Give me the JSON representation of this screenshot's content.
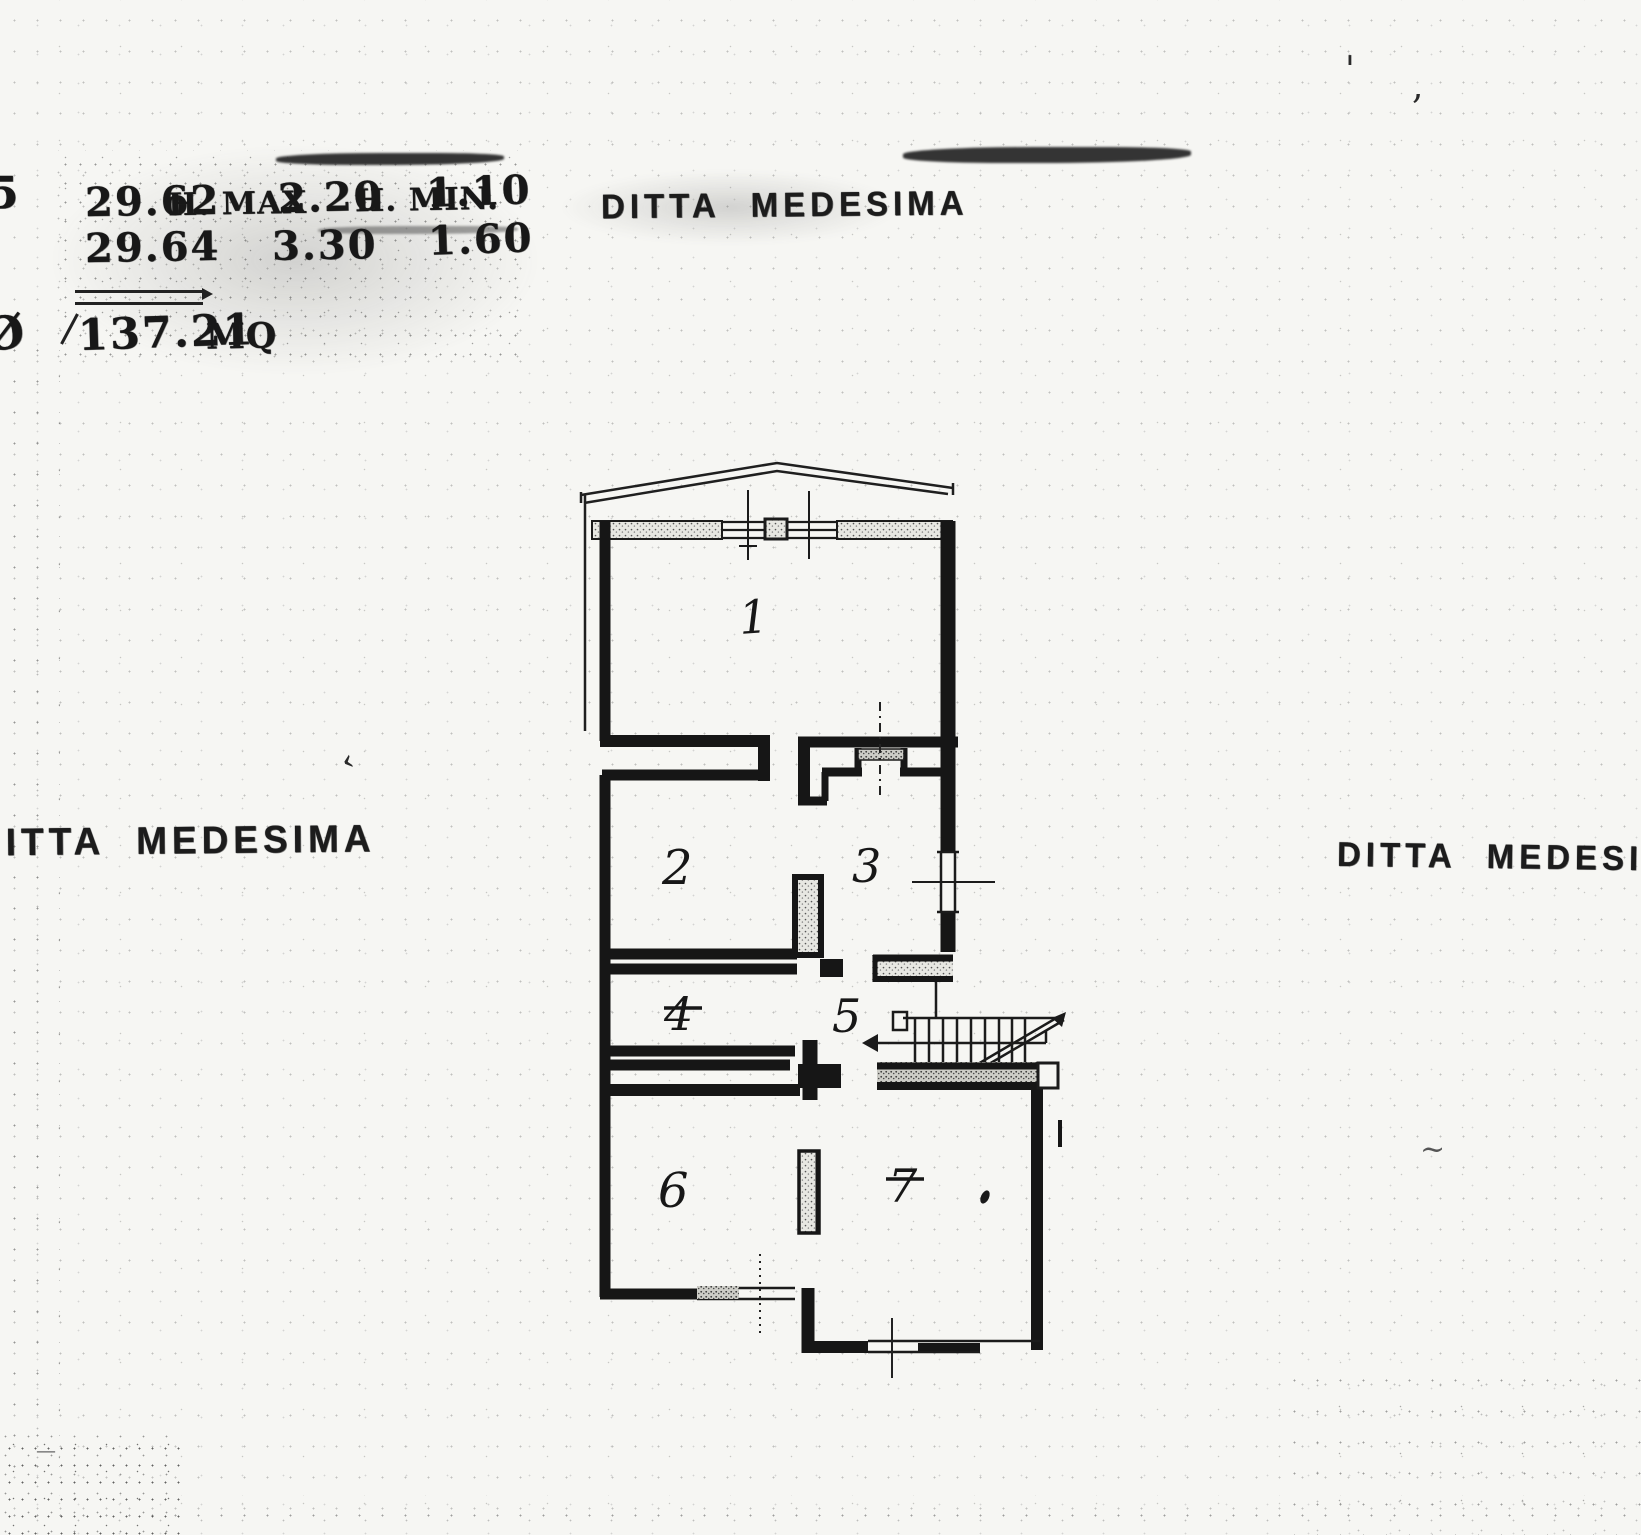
{
  "page": {
    "paper_color": "#f6f6f3",
    "ink_color": "#1b1b1b",
    "description_note": "scanned handwritten cadastral floor plan"
  },
  "annotations": {
    "measure_row1_area": "29.62",
    "measure_row1_hmax_label": "H. MAX",
    "measure_row1_hmax": "2.20",
    "measure_row1_hmin_label": "H. MIN.",
    "measure_row1_hmin": "1.10",
    "measure_row2_area": "29.64",
    "measure_row2_hmax": "3.30",
    "measure_row2_hmin": "1.60",
    "total_area": "137.21",
    "total_unit": "MQ",
    "edge_fragment_top": "5",
    "edge_fragment_bottom": "Ø",
    "ditta_top": "DITTA MEDESIMA",
    "ditta_left": "DITTA MEDESIMA",
    "ditta_right": "DITTA MEDESIMA"
  },
  "floor_plan": {
    "rooms": [
      {
        "number": "1"
      },
      {
        "number": "2"
      },
      {
        "number": "3"
      },
      {
        "number": "4"
      },
      {
        "number": "5"
      },
      {
        "number": "6"
      },
      {
        "number": "7"
      }
    ]
  },
  "stray_marks": {
    "m1": "'",
    "m2": ",",
    "m3": "‹",
    "m4": "~",
    "m5": "—"
  }
}
